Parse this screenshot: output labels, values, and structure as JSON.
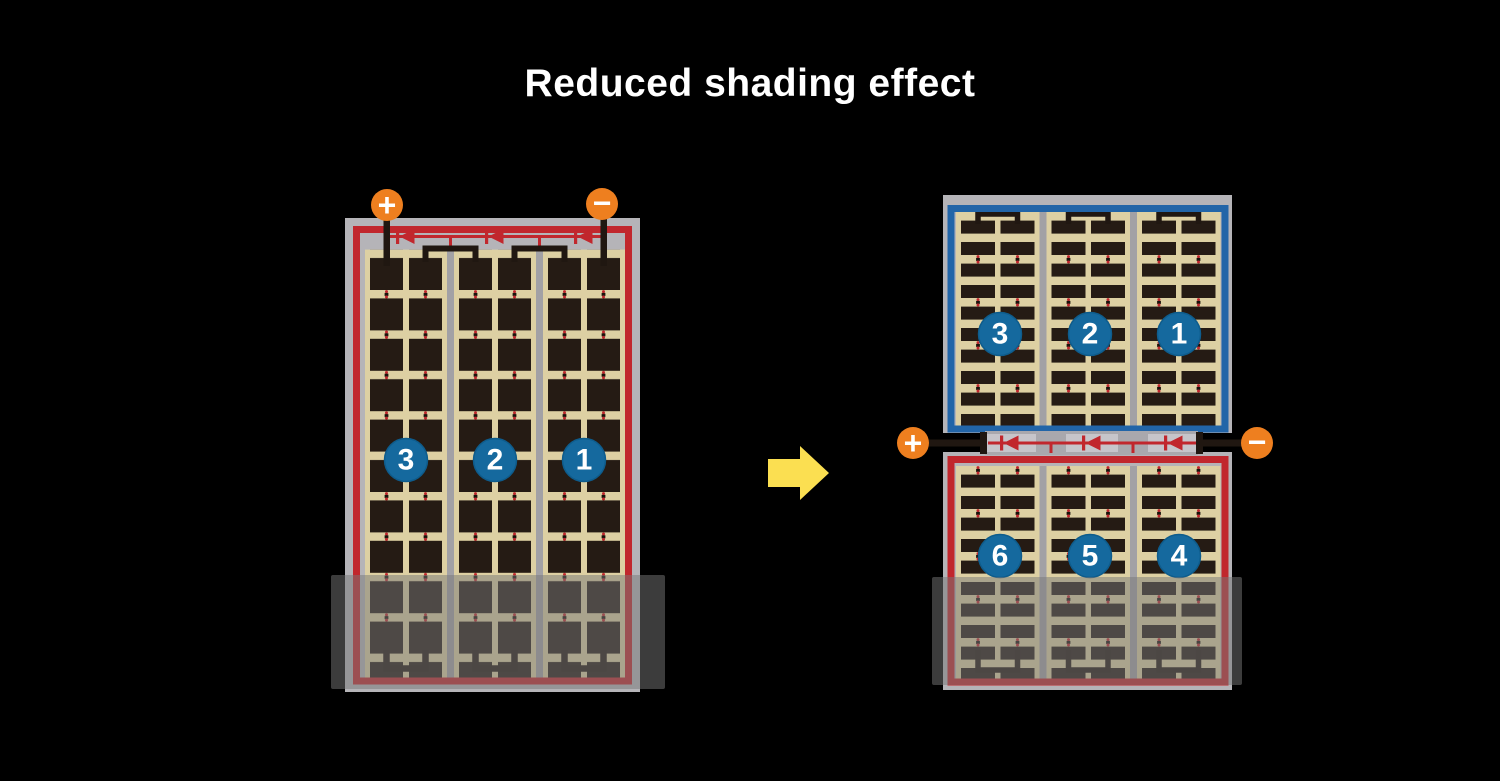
{
  "title": "Reduced shading effect",
  "colors": {
    "background": "#000000",
    "frame-gray": "#b5b4b8",
    "separator-gray": "#a2a1a5",
    "tan": "#ddd0a3",
    "cell-dark": "#251b14",
    "border-red": "#c1272d",
    "border-blue": "#2265a8",
    "terminal-orange": "#ee7f1f",
    "badge-blue": "#15699e",
    "arrow-yellow": "#fbdf51",
    "wire-black": "#201711",
    "shade": "rgba(120,120,120,0.5)"
  },
  "before_panel": {
    "terminal_positive": "+",
    "terminal_negative": "−",
    "cell_groups": [
      "3",
      "2",
      "1"
    ]
  },
  "after_panel": {
    "terminal_positive": "+",
    "terminal_negative": "−",
    "top_cell_groups": [
      "3",
      "2",
      "1"
    ],
    "bottom_cell_groups": [
      "6",
      "5",
      "4"
    ]
  }
}
